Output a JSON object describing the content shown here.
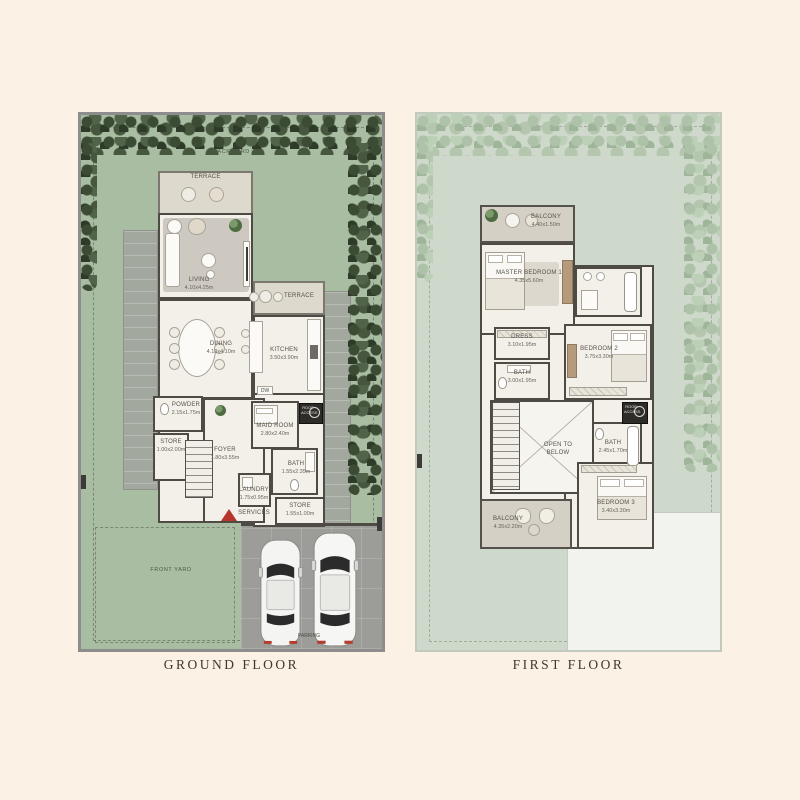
{
  "palette": {
    "background": "#fbf1e4",
    "lawn_green": "#a8bda1",
    "hedge_dark_green": "#45573d",
    "pale_yard_green": "#cfd9cb",
    "hedge_pale_green": "#b4c5af",
    "wall_gray": "#4e4b45",
    "floor_cream": "#f3f0e9",
    "terrace_beige": "#ded9cd",
    "garage_gray": "#9c9c98",
    "entrance_red": "#b7352c"
  },
  "captions": {
    "ground": "GROUND FLOOR",
    "first": "FIRST FLOOR"
  },
  "ground": {
    "back_yard": "BACK YARD",
    "front_yard": "FRONT YARD",
    "parking": "PARKING",
    "dw": "DW",
    "roof_access": "ROOF ACCESS",
    "services": "SERVICES",
    "terrace_top": {
      "name": "TERRACE"
    },
    "terrace_side": {
      "name": "TERRACE"
    },
    "living": {
      "name": "LIVING",
      "dim": "4.10x4.25m"
    },
    "dining": {
      "name": "DINING",
      "dim": "4.10x4.10m"
    },
    "kitchen": {
      "name": "KITCHEN",
      "dim": "3.50x3.90m"
    },
    "powder": {
      "name": "POWDER",
      "dim": "2.15x1.75m"
    },
    "store_1": {
      "name": "STORE",
      "dim": "1.00x2.00m"
    },
    "foyer": {
      "name": "FOYER",
      "dim": "1.80x3.55m"
    },
    "maid": {
      "name": "MAID ROOM",
      "dim": "2.80x2.40m"
    },
    "bath": {
      "name": "BATH",
      "dim": "1.55x2.35m"
    },
    "laundry": {
      "name": "LAUNDRY",
      "dim": "1.75x0.95m"
    },
    "store_2": {
      "name": "STORE",
      "dim": "1.55x1.00m"
    }
  },
  "first": {
    "roof_access": "ROOF ACCESS",
    "open_below": "OPEN TO BELOW",
    "balcony_top": {
      "name": "BALCONY",
      "dim": "4.40x1.50m"
    },
    "master": {
      "name": "MASTER BEDROOM 1",
      "dim": "4.35x5.60m"
    },
    "dress": {
      "name": "DRESS",
      "dim": "3.10x1.95m"
    },
    "bath_1": {
      "name": "BATH",
      "dim": "3.00x1.95m"
    },
    "bedroom_2": {
      "name": "BEDROOM 2",
      "dim": "3.75x3.30m"
    },
    "bath_2": {
      "name": "BATH",
      "dim": "2.45x1.70m"
    },
    "balcony_bottom": {
      "name": "BALCONY",
      "dim": "4.35x2.20m"
    },
    "bedroom_3": {
      "name": "BEDROOM 3",
      "dim": "3.40x3.30m"
    }
  }
}
